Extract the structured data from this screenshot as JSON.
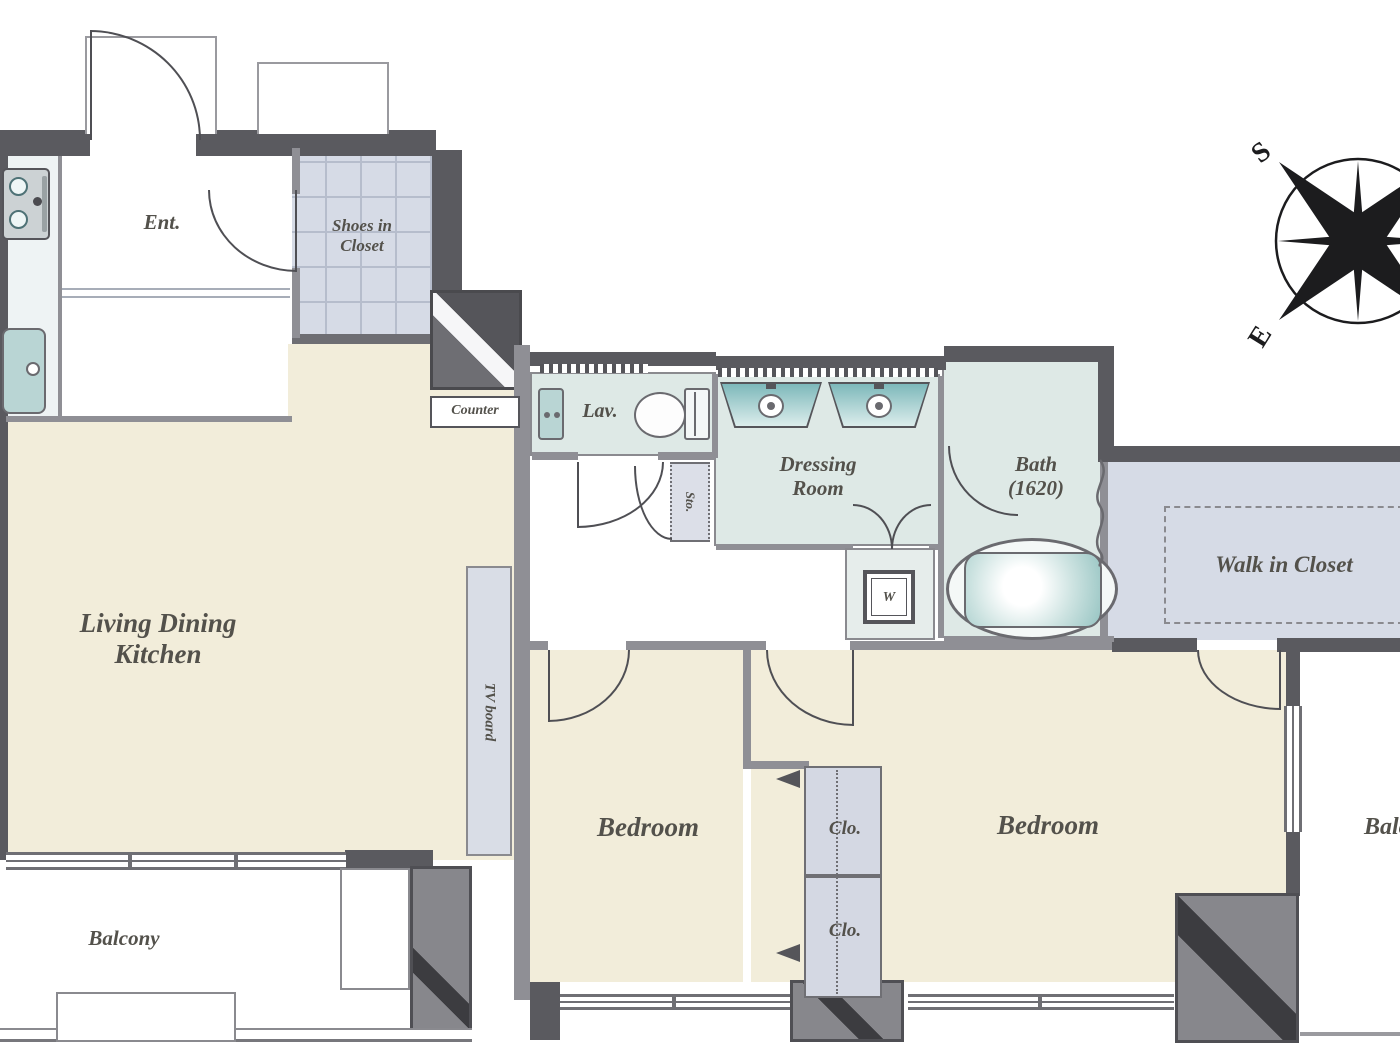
{
  "plan_title": "apartment-floor-plan",
  "rooms": {
    "ldk": {
      "line1": "Living Dining",
      "line2": "Kitchen"
    },
    "entrance": {
      "label": "Ent."
    },
    "shoes_closet": {
      "line1": "Shoes in",
      "line2": "Closet"
    },
    "lavatory": {
      "label": "Lav."
    },
    "storage": {
      "label": "Sto."
    },
    "dressing_room": {
      "line1": "Dressing",
      "line2": "Room"
    },
    "bath": {
      "line1": "Bath",
      "line2": "(1620)"
    },
    "washer": {
      "label": "W"
    },
    "walk_in_closet": {
      "label": "Walk in Closet"
    },
    "bedroom_left": {
      "label": "Bedroom"
    },
    "bedroom_right": {
      "label": "Bedroom"
    },
    "closet_upper": {
      "label": "Clo."
    },
    "closet_lower": {
      "label": "Clo."
    },
    "balcony_main": {
      "label": "Balcony"
    },
    "balcony_right": {
      "label": "Balcony"
    }
  },
  "fixtures": {
    "counter_label": "Counter",
    "tv_board_label": "TV board"
  },
  "compass": {
    "south": "S",
    "east": "E"
  },
  "colors": {
    "room_beige": "#f2edda",
    "room_teal": "#dee9e6",
    "room_grey": "#d6dbe6",
    "wall_dark": "#5a5a5f",
    "wall_light": "#8f8f95",
    "fixture_teal": "#a9cfce",
    "label_text": "#53514b",
    "compass_black": "#1c1c1e"
  }
}
